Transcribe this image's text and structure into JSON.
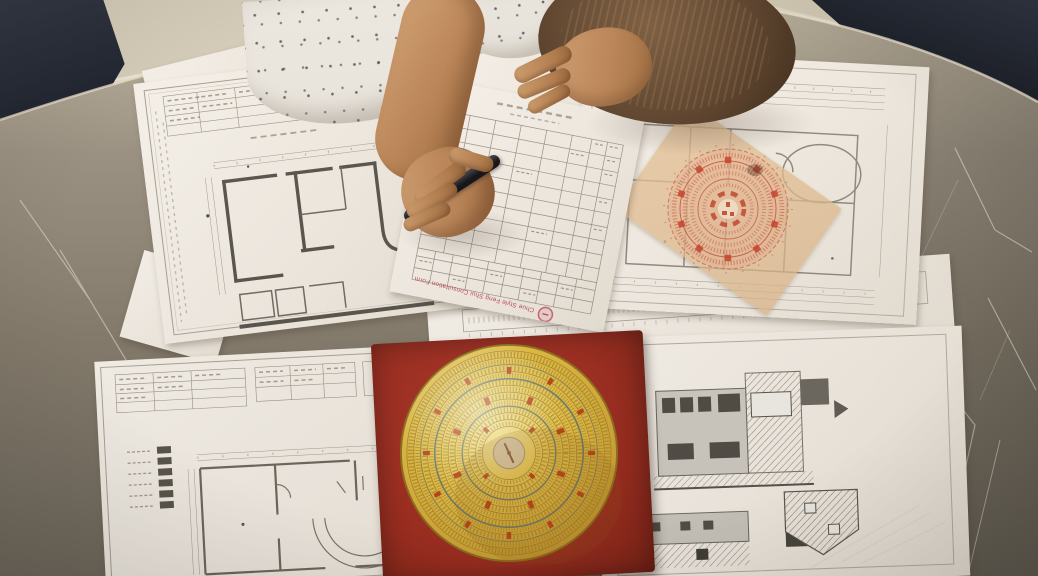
{
  "stamp": {
    "text": "Chue Style Feng Shui Consultation Form",
    "color": "#c64a5a"
  },
  "objects": {
    "table": "round marble table",
    "left_plan": "architectural floor plan sheet",
    "form": "feng shui consultation grid form",
    "right_plan": "floor plan with luopan chart overlay",
    "overlay_paper": "translucent luopan chart paper",
    "bottom_plan": "ground floor plan sheet",
    "elevation_sheet": "building elevation drawings sheet",
    "luopan": "gold luopan compass on red wooden base",
    "person": "practitioner writing with a pen"
  },
  "colors": {
    "floor": "#d3c9b5",
    "marble": "#847a6a",
    "paper": "#f4efe7",
    "base_red": "#a62c1c",
    "gold": "#e3bb3c",
    "print_red": "#cf4a32",
    "hair": "#5d4129",
    "skin": "#bd8352",
    "clothing_navy": "#1d222e"
  }
}
